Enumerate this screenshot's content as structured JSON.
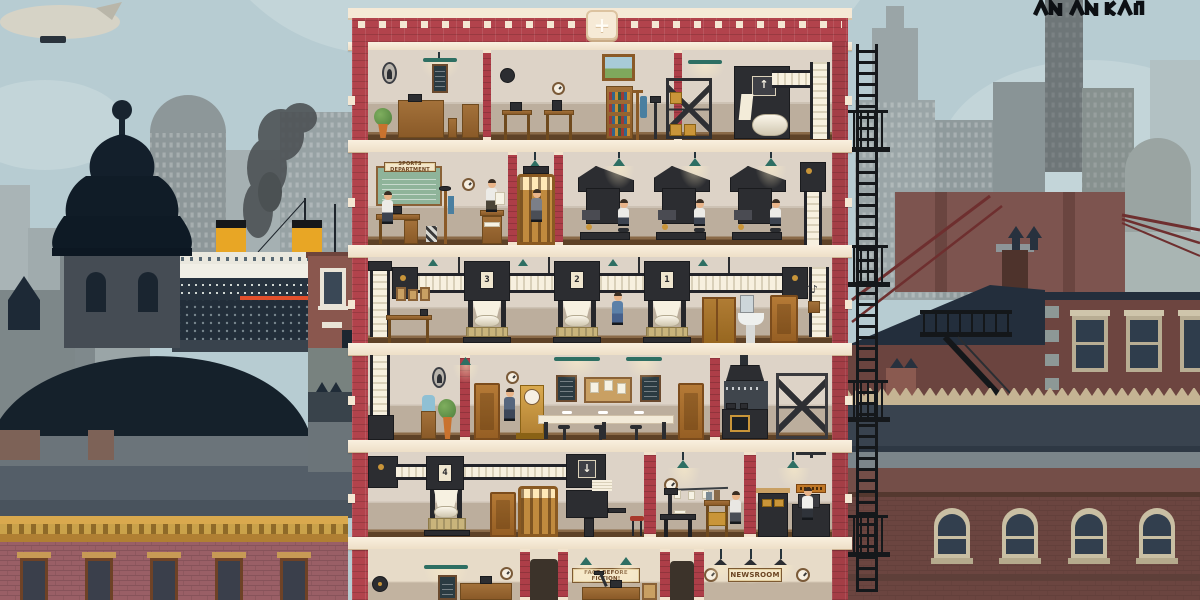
{
  "scene": {
    "roof": {
      "add_floor_label": "+"
    },
    "signs": {
      "sports_department": "SPORTS DEPARTMENT",
      "fact_before_fiction": "FACT BEFORE FICTION!",
      "newsroom": "NEWSROOM"
    },
    "press_units": {
      "floor3": [
        "3",
        "2",
        "1"
      ],
      "floor5": [
        "4"
      ]
    },
    "decor": {
      "music_notes": "♪♪",
      "up_arrow": "↑",
      "down_arrow": "↓"
    },
    "colors": {
      "sky": "#b7ccd2",
      "brick": "#b2434c",
      "cream_trim": "#f4e7d3",
      "teal_lamp": "#2e6f63",
      "wood": "#9a6a33",
      "machine": "#2c2d31",
      "paper": "#f5eedd",
      "gold": "#c99539",
      "funnel_yellow": "#e8a625",
      "mauve_building": "#9a5f66",
      "maroon_building": "#6b4540",
      "cornice_tan": "#c28f41",
      "navy_roof": "#232e3c",
      "red_stripe": "#e14f2c"
    }
  }
}
